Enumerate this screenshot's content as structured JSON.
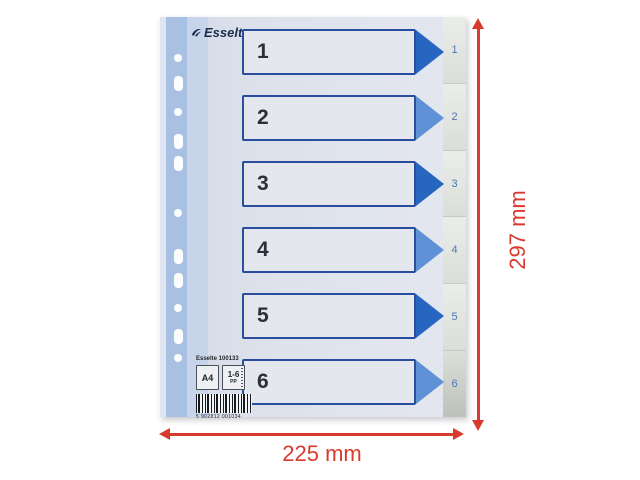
{
  "sheet": {
    "brand": "Esselte",
    "rows": [
      {
        "number": "1"
      },
      {
        "number": "2"
      },
      {
        "number": "3"
      },
      {
        "number": "4"
      },
      {
        "number": "5"
      },
      {
        "number": "6"
      }
    ],
    "tabs": [
      "1",
      "2",
      "3",
      "4",
      "5",
      "6"
    ],
    "info_block": {
      "product_line": "Esselte 100133",
      "format_badge": "A4",
      "range_badge": "1-6",
      "material_badge": "PP",
      "barcode_text": "5 902812 001034"
    }
  },
  "annotations": {
    "width_label": "225 mm",
    "height_label": "297 mm"
  },
  "colors": {
    "annotation_red": "#d93a2e",
    "box_border_blue": "#2b4d9d",
    "box_fill": "#e4e7ee",
    "arrow_dark_blue": "#2766c0",
    "arrow_light_blue": "#5f91d6",
    "tab_number_blue": "#4d77b5",
    "punch_strip_blue": "#a8c0e1",
    "sheet_body": "#dde2ec",
    "tab_column_gray": "#e4e7e3",
    "logo_navy": "#1d2c4e"
  }
}
